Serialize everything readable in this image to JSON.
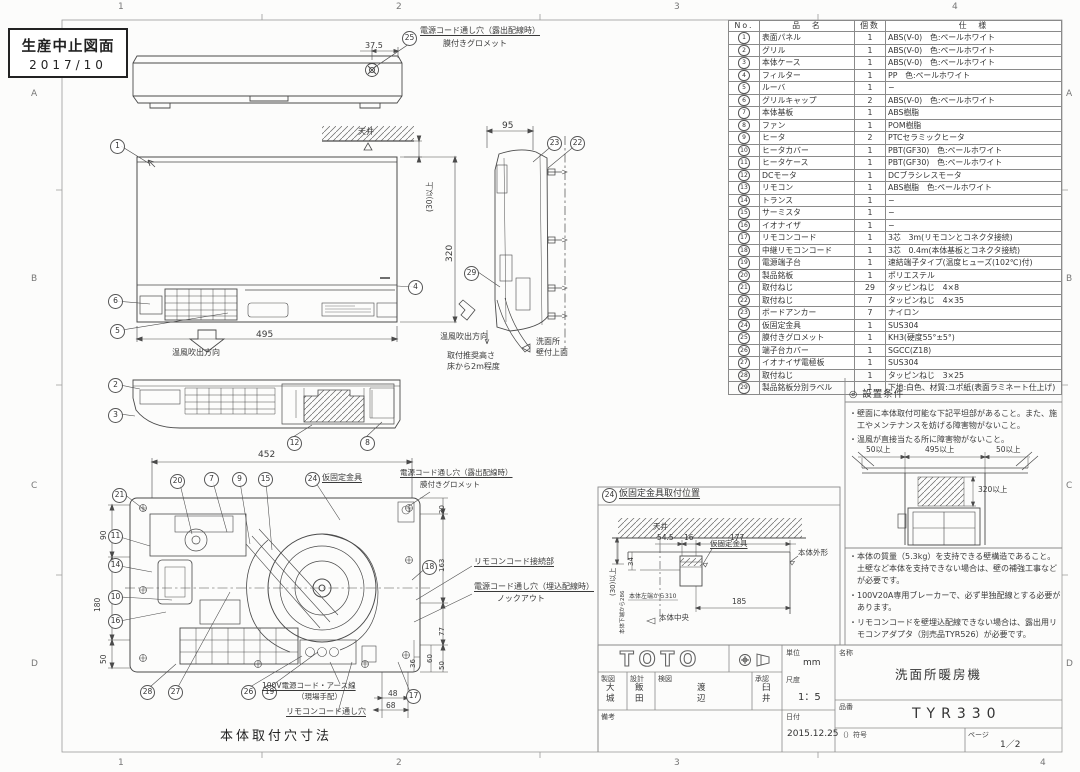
{
  "stamp": {
    "line1": "生産中止図面",
    "line2": "2017/10"
  },
  "zones": {
    "top": [
      "1",
      "2",
      "3",
      "4"
    ],
    "bottom": [
      "1",
      "2",
      "3",
      "4"
    ],
    "left": [
      "A",
      "B",
      "C",
      "D"
    ],
    "right": [
      "A",
      "B",
      "C",
      "D"
    ]
  },
  "parts_table": {
    "headers": {
      "no": "No.",
      "name": "品　名",
      "qty": "個数",
      "spec": "仕　様"
    },
    "rows": [
      {
        "no": "1",
        "name": "表面パネル",
        "qty": "1",
        "spec": "ABS(V-0)　色:ペールホワイト"
      },
      {
        "no": "2",
        "name": "グリル",
        "qty": "1",
        "spec": "ABS(V-0)　色:ペールホワイト"
      },
      {
        "no": "3",
        "name": "本体ケース",
        "qty": "1",
        "spec": "ABS(V-0)　色:ペールホワイト"
      },
      {
        "no": "4",
        "name": "フィルター",
        "qty": "1",
        "spec": "PP　色:ペールホワイト"
      },
      {
        "no": "5",
        "name": "ルーバ",
        "qty": "1",
        "spec": "−"
      },
      {
        "no": "6",
        "name": "グリルキャップ",
        "qty": "2",
        "spec": "ABS(V-0)　色:ペールホワイト"
      },
      {
        "no": "7",
        "name": "本体基板",
        "qty": "1",
        "spec": "ABS樹脂"
      },
      {
        "no": "8",
        "name": "ファン",
        "qty": "1",
        "spec": "POM樹脂"
      },
      {
        "no": "9",
        "name": "ヒータ",
        "qty": "2",
        "spec": "PTCセラミックヒータ"
      },
      {
        "no": "10",
        "name": "ヒータカバー",
        "qty": "1",
        "spec": "PBT(GF30)　色:ペールホワイト"
      },
      {
        "no": "11",
        "name": "ヒータケース",
        "qty": "1",
        "spec": "PBT(GF30)　色:ペールホワイト"
      },
      {
        "no": "12",
        "name": "DCモータ",
        "qty": "1",
        "spec": "DCブラシレスモータ"
      },
      {
        "no": "13",
        "name": "リモコン",
        "qty": "1",
        "spec": "ABS樹脂　色:ペールホワイト"
      },
      {
        "no": "14",
        "name": "トランス",
        "qty": "1",
        "spec": "−"
      },
      {
        "no": "15",
        "name": "サーミスタ",
        "qty": "1",
        "spec": "−"
      },
      {
        "no": "16",
        "name": "イオナイザ",
        "qty": "1",
        "spec": "−"
      },
      {
        "no": "17",
        "name": "リモコンコード",
        "qty": "1",
        "spec": "3芯　3m(リモコンとコネクタ接続)"
      },
      {
        "no": "18",
        "name": "中継リモコンコード",
        "qty": "1",
        "spec": "3芯　0.4m(本体基板とコネクタ接続)"
      },
      {
        "no": "19",
        "name": "電源端子台",
        "qty": "1",
        "spec": "速結端子タイプ(温度ヒューズ(102℃)付)"
      },
      {
        "no": "20",
        "name": "製品銘板",
        "qty": "1",
        "spec": "ポリエステル"
      },
      {
        "no": "21",
        "name": "取付ねじ",
        "qty": "29",
        "spec": "タッピンねじ　4×8"
      },
      {
        "no": "22",
        "name": "取付ねじ",
        "qty": "7",
        "spec": "タッピンねじ　4×35"
      },
      {
        "no": "23",
        "name": "ボードアンカー",
        "qty": "7",
        "spec": "ナイロン"
      },
      {
        "no": "24",
        "name": "仮固定金具",
        "qty": "1",
        "spec": "SUS304"
      },
      {
        "no": "25",
        "name": "膜付きグロメット",
        "qty": "1",
        "spec": "KH3(硬度55°±5°)"
      },
      {
        "no": "26",
        "name": "端子台カバー",
        "qty": "1",
        "spec": "SGCC(Z18)"
      },
      {
        "no": "27",
        "name": "イオナイザ電極板",
        "qty": "1",
        "spec": "SUS304"
      },
      {
        "no": "28",
        "name": "取付ねじ",
        "qty": "1",
        "spec": "タッピンねじ　3×25"
      },
      {
        "no": "29",
        "name": "製品銘板分別ラベル",
        "qty": "1",
        "spec": "下地:白色、材質:ユポ紙(表面ラミネート仕上げ)"
      }
    ]
  },
  "top_view": {
    "balloon": "25",
    "hole_label": "電源コード通し穴（露出配線時）",
    "grommet_label": "膜付きグロメット",
    "dim": "37.5"
  },
  "front_view": {
    "balloons": [
      "1",
      "4",
      "5",
      "6"
    ],
    "ceiling": "天井",
    "gap_dim": "(30)以上",
    "width_dim": "495",
    "height_dim": "320",
    "flow": "温風吹出方向"
  },
  "side_view": {
    "balloons": [
      "23",
      "22",
      "29"
    ],
    "depth_dim": "95",
    "flow": "温風吹出方向",
    "mount_note1": "取付推奨高さ",
    "mount_note2": "床から2m程度",
    "wall_note1": "洗面所",
    "wall_note2": "壁付上面"
  },
  "bottom_view": {
    "balloons": [
      "2",
      "3",
      "12",
      "8"
    ]
  },
  "internal_view": {
    "caption": "本体取付穴寸法",
    "width_dim": "452",
    "top_balloons": [
      "21",
      "20",
      "7",
      "9",
      "15",
      "24"
    ],
    "left_balloons": [
      "11",
      "14",
      "10",
      "16"
    ],
    "bottom_balloons": [
      "28",
      "27",
      "26",
      "19",
      "17"
    ],
    "right_balloon": "18",
    "left_dims": [
      "90",
      "180",
      "50"
    ],
    "right_dims": [
      "30",
      "163",
      "77",
      "60",
      "50",
      "36"
    ],
    "corner_dims": [
      "48",
      "68"
    ],
    "bracket_label": "仮固定金具",
    "hole_exposed": "電源コード通し穴（露出配線時）",
    "grommet": "膜付きグロメット",
    "remote_conn": "リモコンコード接続部",
    "hole_embedded": "電源コード通し穴（埋込配線時）",
    "knockout": "ノックアウト",
    "power_cord1": "100V電源コード・アース線",
    "power_cord2": "（現場手配）",
    "remote_hole": "リモコンコード通し穴"
  },
  "bracket_panel": {
    "balloon": "24",
    "title": "仮固定金具取付位置",
    "ceiling": "天井",
    "dims": {
      "d545": "54.5",
      "d16": "16",
      "d177": "177",
      "d185": "185",
      "d34": "34",
      "gap": "(30)以上"
    },
    "from_bottom": "本体下端から286",
    "from_left": "本体左端から310",
    "bracket": "仮固定金具",
    "body_outline": "本体外形",
    "body_center": "本体中央"
  },
  "conditions": {
    "title": "◎ 設置条件",
    "bullets_top": [
      "・壁面に本体取付可能な下記平坦部があること。また、施工やメンテナンスを妨げる障害物がないこと。",
      "・温風が直接当たる所に障害物がないこと。"
    ],
    "diagram_dims": {
      "left": "50以上",
      "center": "495以上",
      "right": "50以上",
      "height": "320以上"
    },
    "bullets_bottom": [
      "・本体の質量（5.3kg）を支持できる壁構造であること。土壁など本体を支持できない場合は、壁の補強工事などが必要です。",
      "・100V20A専用ブレーカーで、必ず単独配線とする必要があります。",
      "・リモコンコードを壁埋込配線できない場合は、露出用リモコンアダプタ（別売品TYR526）が必要です。"
    ]
  },
  "title_block": {
    "logo": "TOTO",
    "unit_label": "単位",
    "unit_value": "mm",
    "name_label": "名称",
    "name_value": "洗面所暖房機",
    "drafter_label": "製図",
    "drafter": "大\n城",
    "designer_label": "設計",
    "designer": "飯\n田",
    "checker_label": "検図",
    "checker": "渡\n辺",
    "approver_label": "承認",
    "approver": "臼\n井",
    "scale_label": "尺度",
    "scale_value": "1：5",
    "part_label": "品番",
    "part_value": "TYR330",
    "remarks_label": "備考",
    "date_label": "日付",
    "date_value": "2015.12.25",
    "symbol_label": "（）符号",
    "page_label": "ページ",
    "page_value": "1／2"
  }
}
